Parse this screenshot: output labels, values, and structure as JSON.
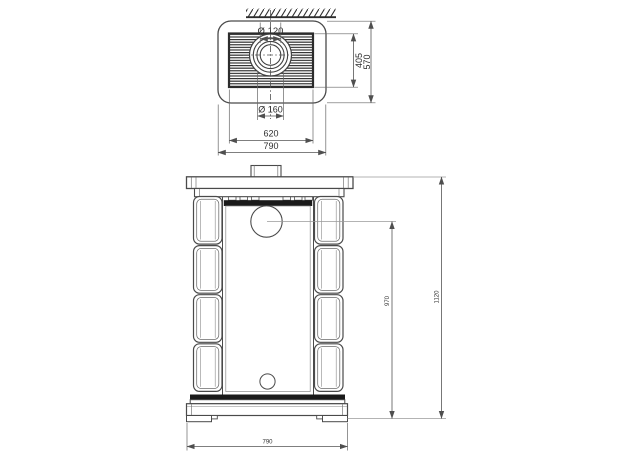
{
  "drawing": {
    "background": "#ffffff",
    "line_color": "#4a4a4a",
    "dimension_color": "#555555",
    "dark_fill": "#1a1a1a",
    "top_view": {
      "flue_inner_diameter": "Ø 120",
      "flue_outer_diameter": "Ø 160",
      "grille_depth": "405",
      "overall_depth": "570",
      "grille_width": "620",
      "overall_width": "790"
    },
    "front_view": {
      "flue_center_height": "970",
      "overall_height": "1120",
      "base_width": "790"
    }
  }
}
